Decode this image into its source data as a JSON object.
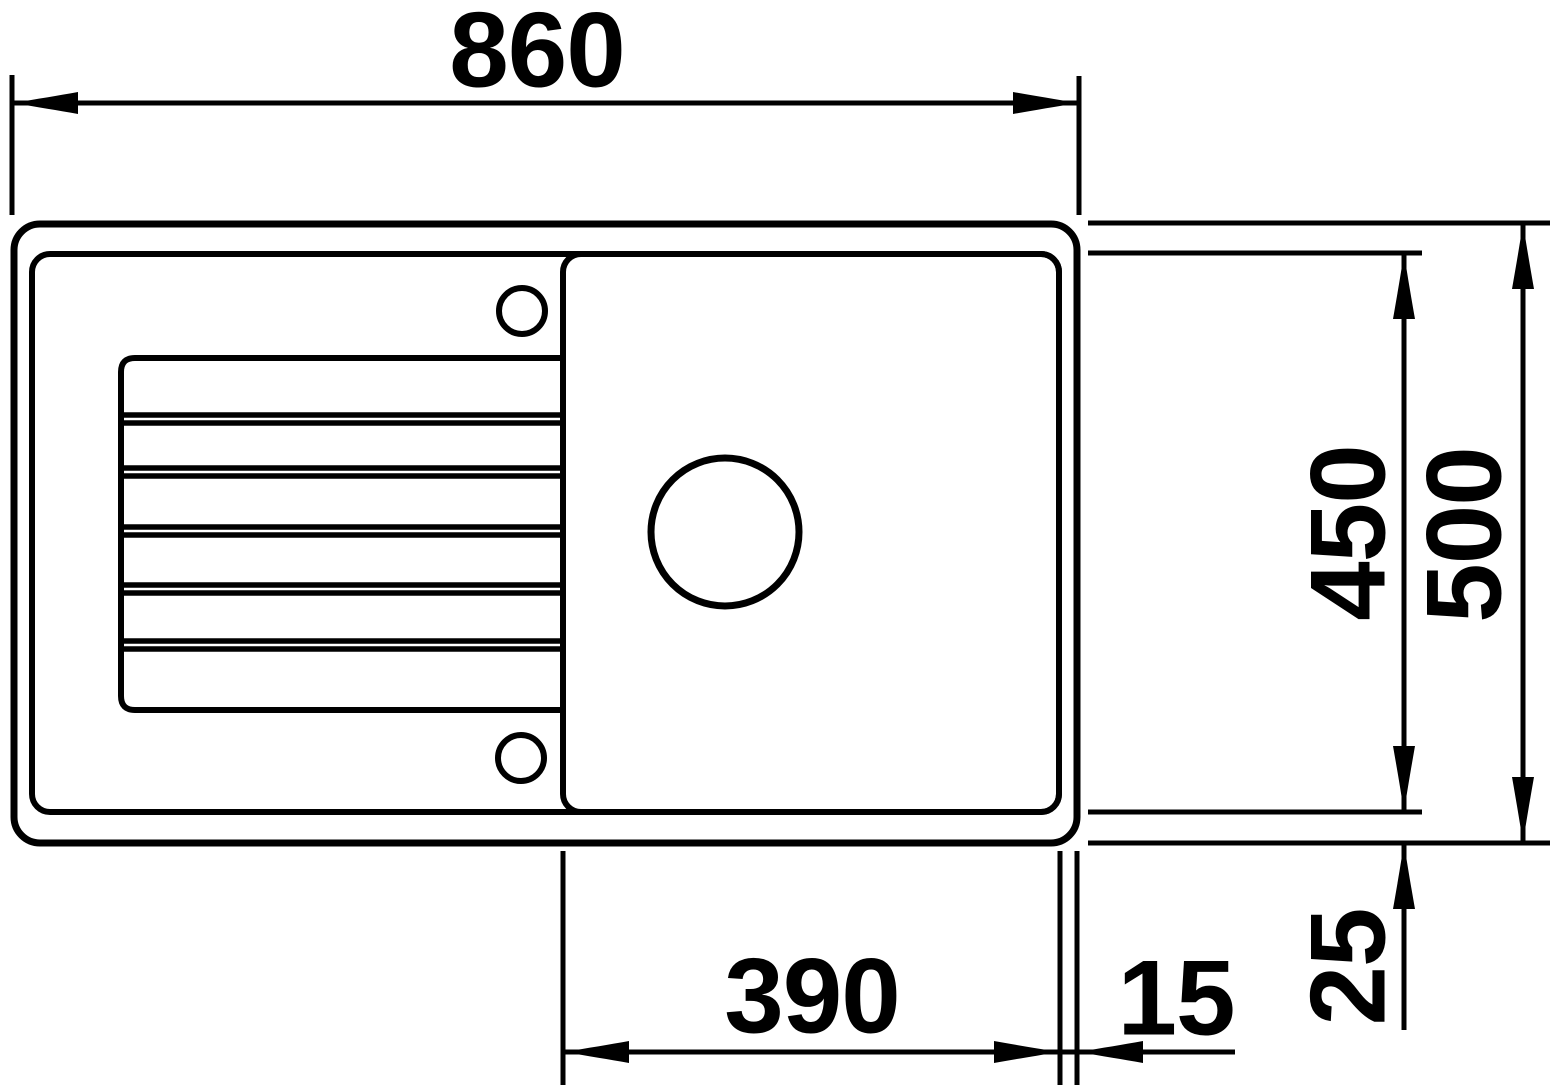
{
  "drawing": {
    "type": "technical-dimension-drawing",
    "subject": "kitchen-sink-top-view-with-drainboard",
    "background_color": "#ffffff",
    "line_color": "#000000"
  },
  "dimensions": {
    "overall_width": "860",
    "bowl_inner_depth": "450",
    "overall_depth": "500",
    "bowl_width": "390",
    "rim_side": "15",
    "rim_bottom": "25"
  }
}
